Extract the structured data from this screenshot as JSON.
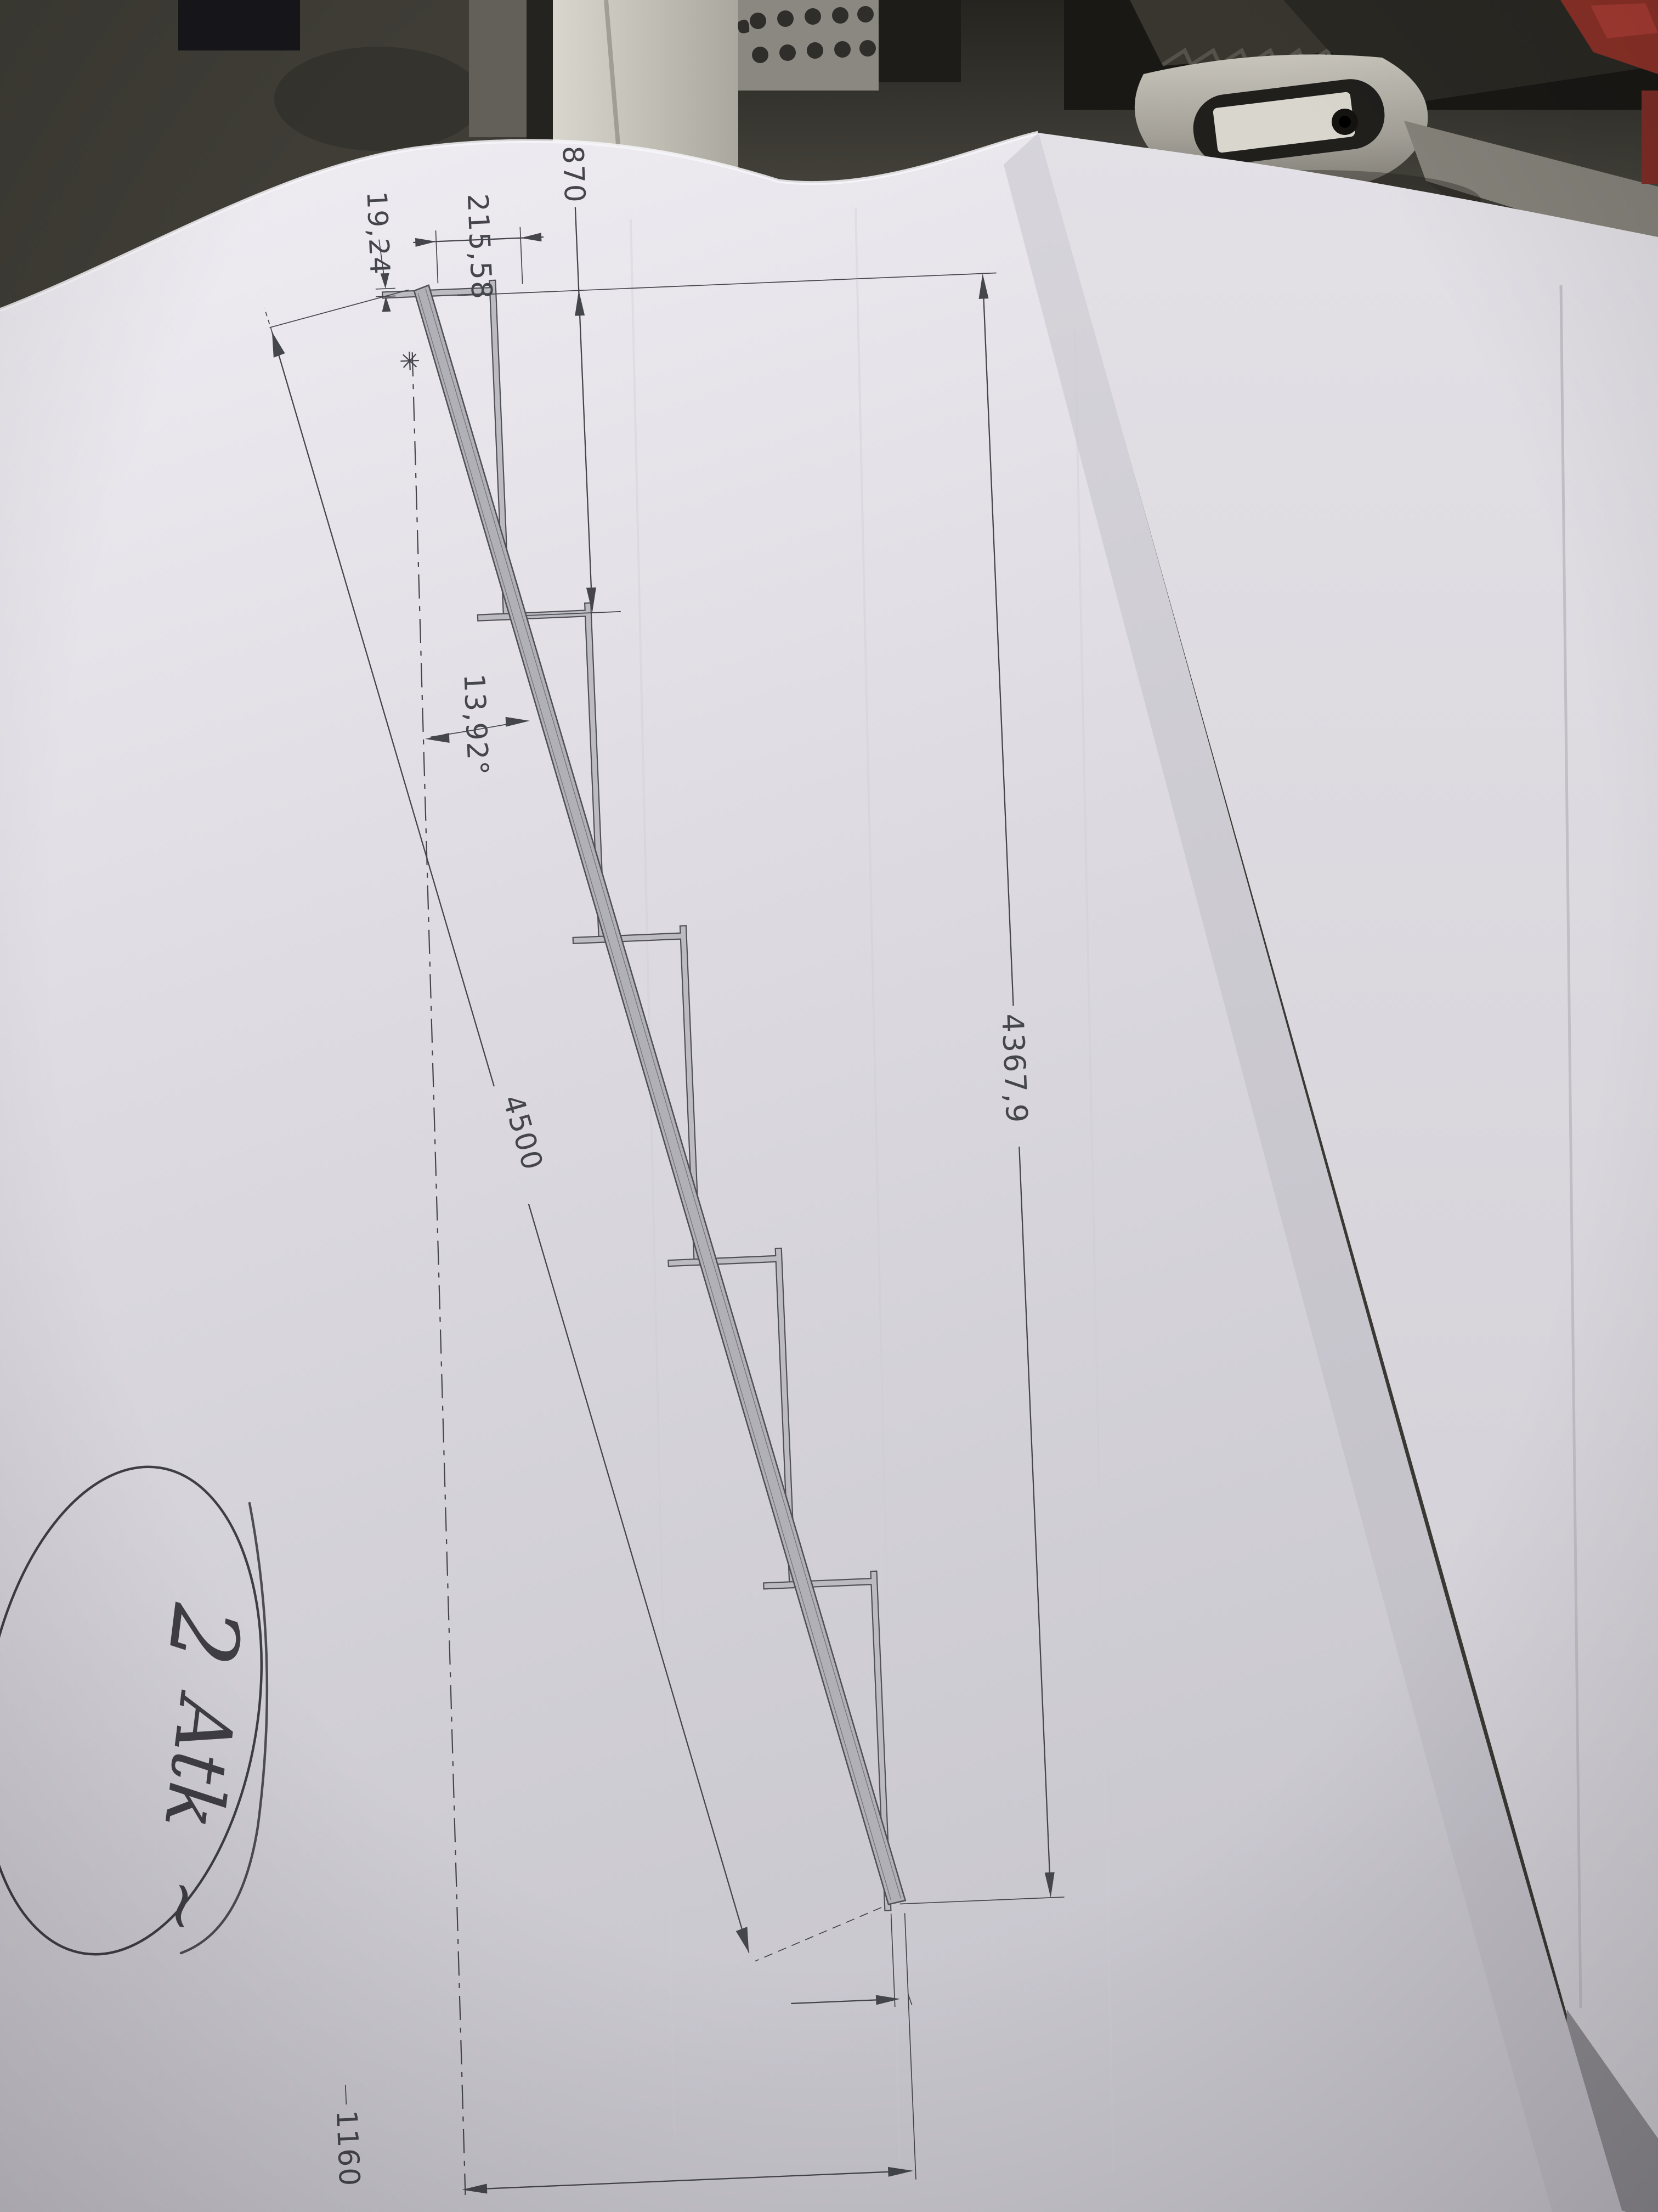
{
  "drawing": {
    "dims": {
      "total_run": "4367,9",
      "slope_length": "4500",
      "first_tread": "870",
      "riser": "215,58",
      "nose_offset": "19,24",
      "slope_angle": "13,92°",
      "end_height": "1160"
    },
    "footnote_marker": "✳"
  },
  "handwritten_note": {
    "quantity": "2",
    "word": "Atk",
    "flourish": "~"
  },
  "bench_ruler": {
    "cm_numbers": [
      "13",
      "14",
      "15",
      "16",
      "17"
    ],
    "mm_numbers": [
      "110",
      "120"
    ]
  }
}
